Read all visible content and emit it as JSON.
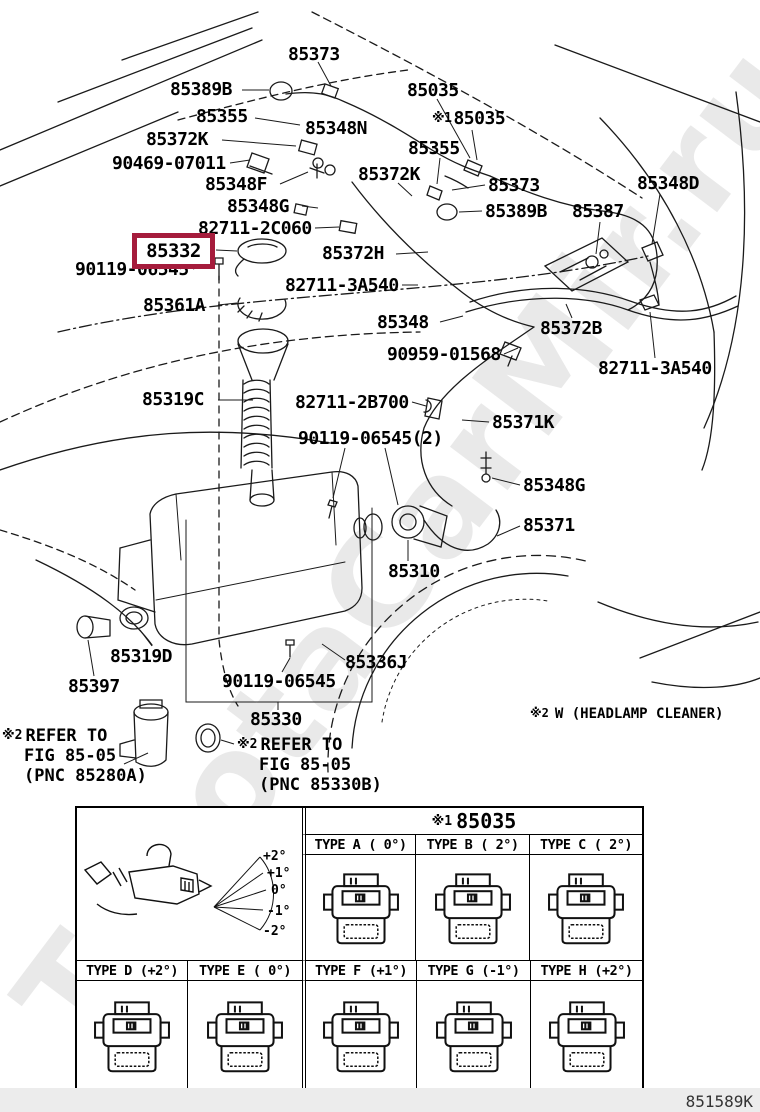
{
  "watermark": {
    "text": "ToyotaCarMir.ru"
  },
  "colors": {
    "highlight_box": "#a51c3c",
    "line_art": "#1a1a1a",
    "footer_strip": "#ececec"
  },
  "diagram": {
    "labels": [
      {
        "text": "85373",
        "x": 288,
        "y": 46
      },
      {
        "text": "85389B",
        "x": 170,
        "y": 81
      },
      {
        "text": "85035",
        "x": 407,
        "y": 82
      },
      {
        "text": "85355",
        "x": 196,
        "y": 108
      },
      {
        "text": "85035",
        "x": 432,
        "y": 110,
        "prefix": "※1"
      },
      {
        "text": "85348N",
        "x": 305,
        "y": 120
      },
      {
        "text": "85372K",
        "x": 146,
        "y": 131
      },
      {
        "text": "85355",
        "x": 408,
        "y": 140
      },
      {
        "text": "90469-07011",
        "x": 112,
        "y": 155
      },
      {
        "text": "85372K",
        "x": 358,
        "y": 166
      },
      {
        "text": "85348F",
        "x": 205,
        "y": 176
      },
      {
        "text": "85348D",
        "x": 637,
        "y": 175
      },
      {
        "text": "85373",
        "x": 488,
        "y": 177
      },
      {
        "text": "85348G",
        "x": 227,
        "y": 198
      },
      {
        "text": "85389B",
        "x": 485,
        "y": 203
      },
      {
        "text": "85387",
        "x": 572,
        "y": 203
      },
      {
        "text": "82711-2C060",
        "x": 198,
        "y": 220
      },
      {
        "text": "85332",
        "x": 132,
        "y": 233,
        "highlight": true
      },
      {
        "text": "85372H",
        "x": 322,
        "y": 245
      },
      {
        "text": "90119-06545",
        "x": 75,
        "y": 261
      },
      {
        "text": "82711-3A540",
        "x": 285,
        "y": 277
      },
      {
        "text": "85361A",
        "x": 143,
        "y": 297
      },
      {
        "text": "85348",
        "x": 377,
        "y": 314
      },
      {
        "text": "85372B",
        "x": 540,
        "y": 320
      },
      {
        "text": "90959-01568",
        "x": 387,
        "y": 346
      },
      {
        "text": "82711-3A540",
        "x": 598,
        "y": 360
      },
      {
        "text": "85319C",
        "x": 142,
        "y": 391
      },
      {
        "text": "82711-2B700",
        "x": 295,
        "y": 394
      },
      {
        "text": "85371K",
        "x": 492,
        "y": 414
      },
      {
        "text": "90119-06545(2)",
        "x": 298,
        "y": 430
      },
      {
        "text": "85348G",
        "x": 523,
        "y": 477
      },
      {
        "text": "85371",
        "x": 523,
        "y": 517
      },
      {
        "text": "85310",
        "x": 388,
        "y": 563
      },
      {
        "text": "85319D",
        "x": 110,
        "y": 648
      },
      {
        "text": "85336J",
        "x": 345,
        "y": 654
      },
      {
        "text": "90119-06545",
        "x": 222,
        "y": 673
      },
      {
        "text": "85397",
        "x": 68,
        "y": 678
      },
      {
        "text": "85330",
        "x": 250,
        "y": 711
      }
    ],
    "highlight_box": {
      "x": 132,
      "y": 233,
      "w": 83,
      "h": 36
    },
    "notes": [
      {
        "prefix": "※2",
        "lines": [
          "REFER TO",
          "FIG 85-05",
          "(PNC 85280A)"
        ],
        "x": 2,
        "y": 726
      },
      {
        "prefix": "※2",
        "lines": [
          "REFER TO",
          "FIG 85-05",
          "(PNC 85330B)"
        ],
        "x": 237,
        "y": 735
      }
    ],
    "variant_note": {
      "prefix": "※2",
      "text": "W (HEADLAMP CLEANER)",
      "x": 530,
      "y": 706
    }
  },
  "table": {
    "header": {
      "prefix": "※1",
      "part": "85035"
    },
    "angle_ticks": [
      "+2°",
      "+1°",
      "0°",
      "-1°",
      "-2°"
    ],
    "top_types": [
      {
        "name": "TYPE A",
        "angle": "( 0°)"
      },
      {
        "name": "TYPE B",
        "angle": "( 2°)"
      },
      {
        "name": "TYPE C",
        "angle": "( 2°)"
      }
    ],
    "bottom_types": [
      {
        "name": "TYPE D",
        "angle": "(+2°)"
      },
      {
        "name": "TYPE E",
        "angle": "( 0°)"
      },
      {
        "name": "TYPE F",
        "angle": "(+1°)"
      },
      {
        "name": "TYPE G",
        "angle": "(-1°)"
      },
      {
        "name": "TYPE H",
        "angle": "(+2°)"
      }
    ]
  },
  "footer": {
    "code": "851589K"
  }
}
